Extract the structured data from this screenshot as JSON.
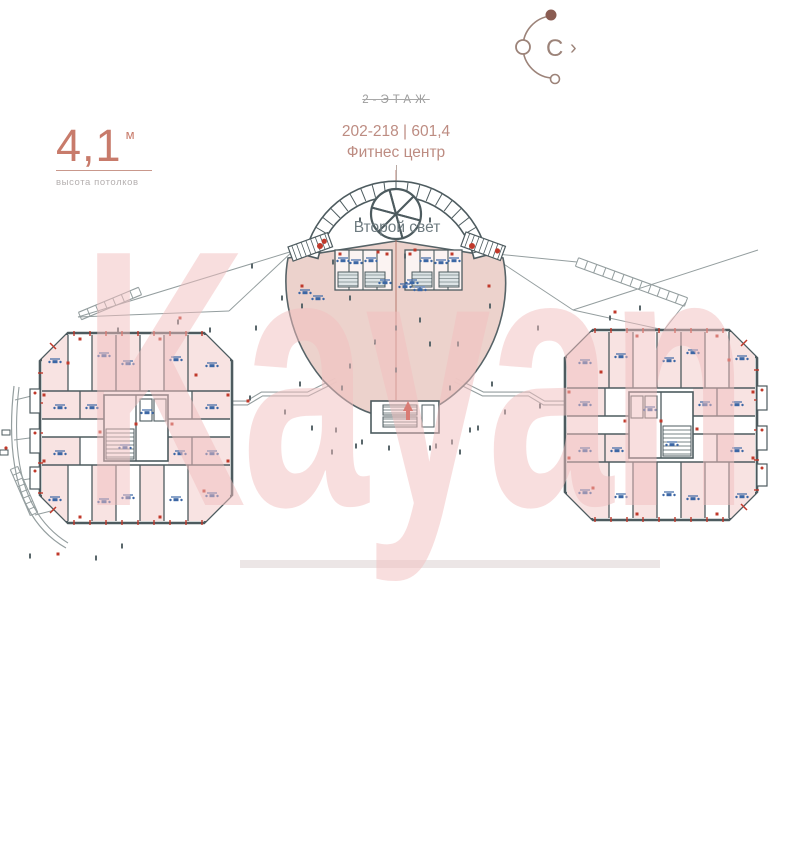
{
  "compass": {
    "north_label": "С",
    "chevron": "›"
  },
  "ceiling_height": {
    "value": "4,1",
    "unit": "м",
    "caption": "высота потолков"
  },
  "floor_header": {
    "floor_label": "2-ЭТАЖ",
    "units_area_text": "202-218 | 601,4",
    "category": "Фитнес центр"
  },
  "plan": {
    "second_light_label": "Второй свет"
  },
  "watermark": {
    "text": "Kayan"
  },
  "colors": {
    "wall": "#4d5b5f",
    "room_fill": "#f8e3e2",
    "dome_fill": "#ecd0ca",
    "cluster_fill": "#fbf3f2",
    "hatch_fill": "#dde4e6",
    "accent_red": "#c0392b",
    "accent_blue": "#3c67a5",
    "terrace_line": "#949e9f",
    "tick_dark": "#5a676b",
    "centerline": "#b06a5e",
    "compass_brown": "#9c8379",
    "compass_dot": "#8a5c52"
  }
}
